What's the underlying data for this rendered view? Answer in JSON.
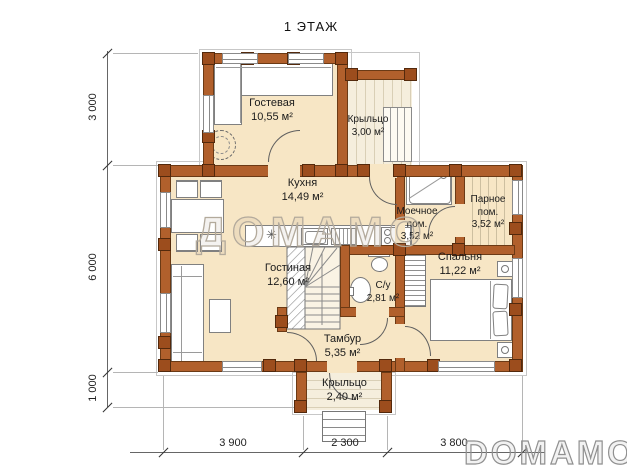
{
  "title": "1 ЭТАЖ",
  "watermark": {
    "center": "ДОМАМО",
    "corner": "DOMAMO"
  },
  "rooms": {
    "guest": {
      "name": "Гостевая",
      "area": "10,55 м²"
    },
    "porch_top": {
      "name": "Крыльцо",
      "area": "3,00 м²"
    },
    "kitchen": {
      "name": "Кухня",
      "area": "14,49 м²"
    },
    "washing": {
      "name": "Моечное пом.",
      "area": "3,52 м²"
    },
    "steam": {
      "name": "Парное пом.",
      "area": "3,52 м²"
    },
    "living": {
      "name": "Гостиная",
      "area": "12,60 м²"
    },
    "bathroom": {
      "name": "С/у",
      "area": "2,81 м²"
    },
    "bedroom": {
      "name": "Спальня",
      "area": "11,22 м²"
    },
    "vestibule": {
      "name": "Тамбур",
      "area": "5,35 м²"
    },
    "porch_bottom": {
      "name": "Крыльцо",
      "area": "2,40 м²"
    }
  },
  "dimensions": {
    "left": [
      "3 000",
      "6 000",
      "1 000"
    ],
    "bottom": [
      "3 900",
      "2 300",
      "3 800"
    ]
  },
  "colors": {
    "wall": "#b1602c",
    "post": "#9c4d1d",
    "floor": "#f7e6c5",
    "deck": "#f5eedd",
    "outline": "#6b3a15"
  }
}
